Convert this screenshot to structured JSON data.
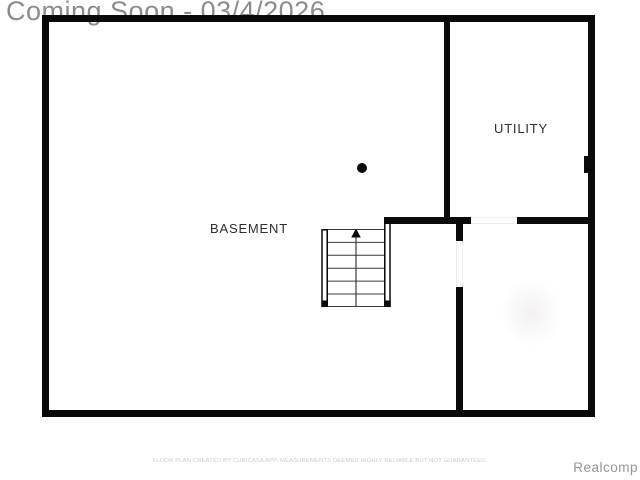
{
  "watermark": {
    "text": "Coming Soon - 03/4/2026"
  },
  "floor_plan": {
    "rooms": [
      {
        "label": "BASEMENT"
      },
      {
        "label": "UTILITY"
      }
    ],
    "icons": {
      "stairs_arrow": "up-arrow-icon",
      "support_column": "filled-circle-dot",
      "electrical_panel": "wall-panel-tab"
    }
  },
  "footer": {
    "disclaimer": "FLOOR PLAN CREATED BY CUBICASA APP. MEASUREMENTS DEEMED HIGHLY RELIABLE BUT NOT GUARANTEED.",
    "brand": "Realcomp"
  },
  "colors": {
    "wall": "#0a0a0a",
    "watermark_text": "#8b8b8b",
    "room_label": "#2e2e2e",
    "disclaimer_text": "#cbcbcb",
    "brand_text": "#959595",
    "background": "#ffffff"
  }
}
